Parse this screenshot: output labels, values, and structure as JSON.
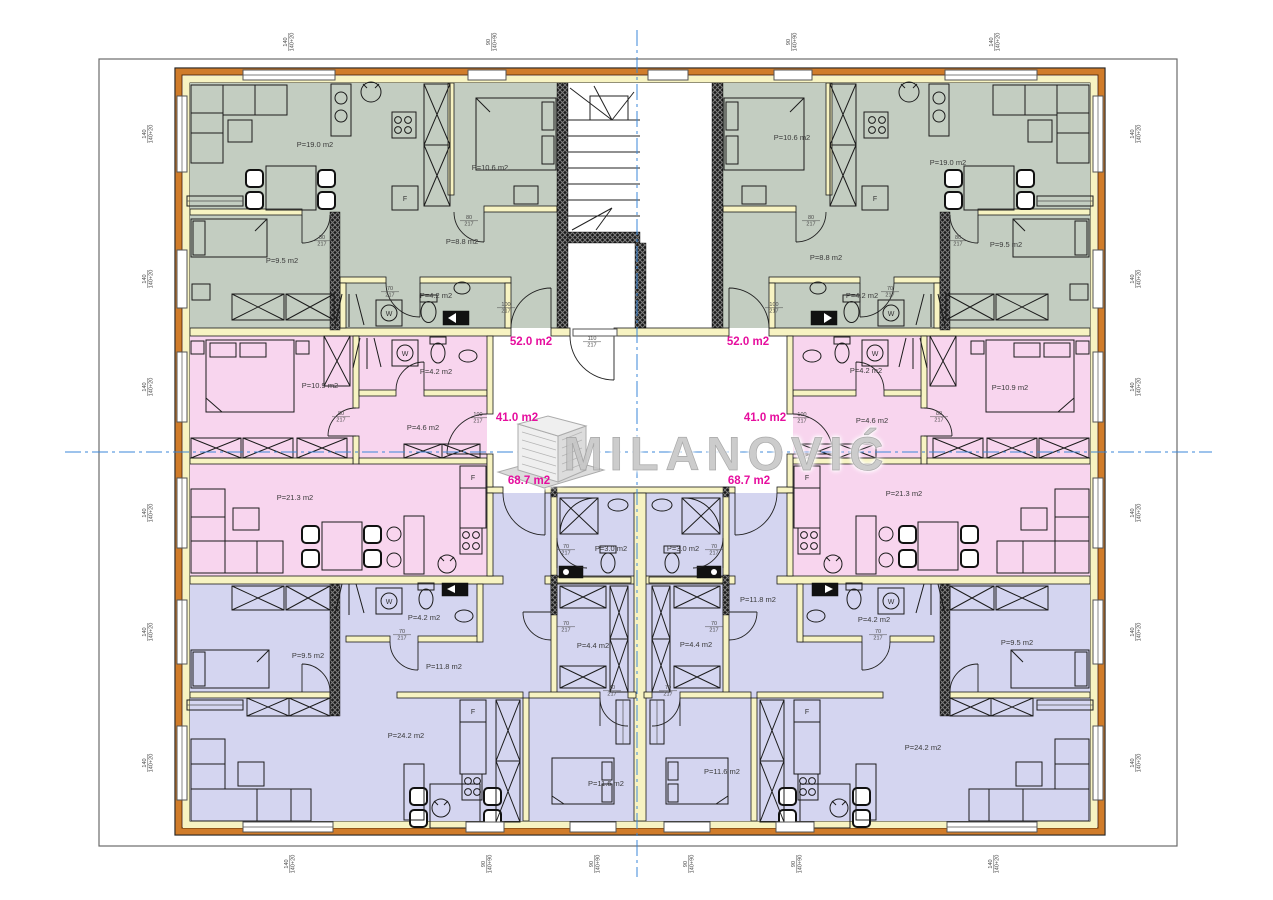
{
  "watermark": {
    "brand": "MILANOVIĆ",
    "icon": "building-3d-icon"
  },
  "colors": {
    "apartment_green": "#c3cdc1",
    "apartment_pink": "#f8d5ee",
    "apartment_blue": "#d4d5f0",
    "wall_yellow": "#f7f3c2",
    "facade_orange": "#d07c2a",
    "area_label_magenta": "#e60e9e",
    "centerline_blue": "#3b87d8"
  },
  "plan": {
    "apartments": [
      {
        "area_label": "52.0 m2",
        "color": "#c3cdc1"
      },
      {
        "area_label": "41.0 m2",
        "color": "#f8d5ee"
      },
      {
        "area_label": "68.7 m2",
        "color": "#d4d5f0"
      }
    ],
    "apartment_area_labels": [
      {
        "text": "52.0 m2",
        "x": 531,
        "y": 345
      },
      {
        "text": "52.0 m2",
        "x": 748,
        "y": 345
      },
      {
        "text": "41.0 m2",
        "x": 517,
        "y": 421
      },
      {
        "text": "41.0 m2",
        "x": 765,
        "y": 421
      },
      {
        "text": "68.7 m2",
        "x": 529,
        "y": 484
      },
      {
        "text": "68.7 m2",
        "x": 749,
        "y": 484
      }
    ],
    "room_labels": [
      {
        "text": "P=19.0 m2",
        "x": 315,
        "y": 147
      },
      {
        "text": "P=10.6 m2",
        "x": 490,
        "y": 170
      },
      {
        "text": "P=8.8 m2",
        "x": 462,
        "y": 244
      },
      {
        "text": "P=9.5 m2",
        "x": 282,
        "y": 263
      },
      {
        "text": "P=4.2 m2",
        "x": 436,
        "y": 298
      },
      {
        "text": "P=19.0 m2",
        "x": 948,
        "y": 165
      },
      {
        "text": "P=10.6 m2",
        "x": 792,
        "y": 140
      },
      {
        "text": "P=8.8 m2",
        "x": 826,
        "y": 260
      },
      {
        "text": "P=9.5 m2",
        "x": 1006,
        "y": 247
      },
      {
        "text": "P=4.2 m2",
        "x": 862,
        "y": 298
      },
      {
        "text": "P=10.9 m2",
        "x": 320,
        "y": 388
      },
      {
        "text": "P=4.2 m2",
        "x": 436,
        "y": 374
      },
      {
        "text": "P=4.6 m2",
        "x": 423,
        "y": 430
      },
      {
        "text": "P=21.3 m2",
        "x": 295,
        "y": 500
      },
      {
        "text": "P=10.9 m2",
        "x": 1010,
        "y": 390
      },
      {
        "text": "P=4.2 m2",
        "x": 866,
        "y": 373
      },
      {
        "text": "P=4.6 m2",
        "x": 872,
        "y": 423
      },
      {
        "text": "P=21.3 m2",
        "x": 904,
        "y": 496
      },
      {
        "text": "P=9.5 m2",
        "x": 308,
        "y": 658
      },
      {
        "text": "P=11.8 m2",
        "x": 444,
        "y": 669
      },
      {
        "text": "P=4.2 m2",
        "x": 424,
        "y": 620
      },
      {
        "text": "P=24.2 m2",
        "x": 406,
        "y": 738
      },
      {
        "text": "P=11.6 m2",
        "x": 606,
        "y": 786
      },
      {
        "text": "P=9.5 m2",
        "x": 1017,
        "y": 645
      },
      {
        "text": "P=11.8 m2",
        "x": 758,
        "y": 602
      },
      {
        "text": "P=4.2 m2",
        "x": 874,
        "y": 622
      },
      {
        "text": "P=24.2 m2",
        "x": 923,
        "y": 750
      },
      {
        "text": "P=11.6 m2",
        "x": 722,
        "y": 774
      },
      {
        "text": "P=3.0 m2",
        "x": 611,
        "y": 551
      },
      {
        "text": "P=3.0 m2",
        "x": 683,
        "y": 551
      },
      {
        "text": "P=4.4 m2",
        "x": 593,
        "y": 648
      },
      {
        "text": "P=4.4 m2",
        "x": 696,
        "y": 647
      }
    ],
    "fixture_labels": [
      {
        "text": "F",
        "x": 405,
        "y": 201
      },
      {
        "text": "F",
        "x": 875,
        "y": 201
      },
      {
        "text": "F",
        "x": 473,
        "y": 480
      },
      {
        "text": "F",
        "x": 807,
        "y": 480
      },
      {
        "text": "F",
        "x": 473,
        "y": 714
      },
      {
        "text": "F",
        "x": 807,
        "y": 714
      },
      {
        "text": "W",
        "x": 389,
        "y": 316
      },
      {
        "text": "W",
        "x": 891,
        "y": 316
      },
      {
        "text": "W",
        "x": 405,
        "y": 356
      },
      {
        "text": "W",
        "x": 875,
        "y": 356
      },
      {
        "text": "W",
        "x": 389,
        "y": 604
      },
      {
        "text": "W",
        "x": 891,
        "y": 604
      }
    ],
    "dimension_labels": [
      {
        "text": "110|217",
        "x": 592,
        "y": 340,
        "rot": 0
      },
      {
        "text": "100|217",
        "x": 506,
        "y": 306,
        "rot": 0
      },
      {
        "text": "100|217",
        "x": 774,
        "y": 306,
        "rot": 0
      },
      {
        "text": "100|217",
        "x": 478,
        "y": 416,
        "rot": 0
      },
      {
        "text": "100|217",
        "x": 802,
        "y": 416,
        "rot": 0
      },
      {
        "text": "80|217",
        "x": 322,
        "y": 239,
        "rot": 0
      },
      {
        "text": "80|217",
        "x": 958,
        "y": 239,
        "rot": 0
      },
      {
        "text": "80|217",
        "x": 469,
        "y": 219,
        "rot": 0
      },
      {
        "text": "80|217",
        "x": 811,
        "y": 219,
        "rot": 0
      },
      {
        "text": "80|217",
        "x": 341,
        "y": 415,
        "rot": 0
      },
      {
        "text": "80|217",
        "x": 939,
        "y": 415,
        "rot": 0
      },
      {
        "text": "70|217",
        "x": 390,
        "y": 290,
        "rot": 0
      },
      {
        "text": "70|217",
        "x": 890,
        "y": 290,
        "rot": 0
      },
      {
        "text": "70|217",
        "x": 566,
        "y": 548,
        "rot": 0
      },
      {
        "text": "70|217",
        "x": 714,
        "y": 548,
        "rot": 0
      },
      {
        "text": "70|217",
        "x": 566,
        "y": 625,
        "rot": 0
      },
      {
        "text": "70|217",
        "x": 714,
        "y": 625,
        "rot": 0
      },
      {
        "text": "70|217",
        "x": 402,
        "y": 633,
        "rot": 0
      },
      {
        "text": "70|217",
        "x": 878,
        "y": 633,
        "rot": 0
      },
      {
        "text": "70|217",
        "x": 612,
        "y": 689,
        "rot": 0
      },
      {
        "text": "70|217",
        "x": 668,
        "y": 689,
        "rot": 0
      },
      {
        "text": "140|140+20",
        "x": 287,
        "y": 42,
        "rot": -90
      },
      {
        "text": "90|140+90",
        "x": 490,
        "y": 42,
        "rot": -90
      },
      {
        "text": "90|140+90",
        "x": 790,
        "y": 42,
        "rot": -90
      },
      {
        "text": "140|140+20",
        "x": 993,
        "y": 42,
        "rot": -90
      },
      {
        "text": "140|140+20",
        "x": 288,
        "y": 864,
        "rot": -90
      },
      {
        "text": "90|140+90",
        "x": 485,
        "y": 864,
        "rot": -90
      },
      {
        "text": "90|140+90",
        "x": 593,
        "y": 864,
        "rot": -90
      },
      {
        "text": "90|140+90",
        "x": 687,
        "y": 864,
        "rot": -90
      },
      {
        "text": "90|140+90",
        "x": 795,
        "y": 864,
        "rot": -90
      },
      {
        "text": "140|140+20",
        "x": 992,
        "y": 864,
        "rot": -90
      },
      {
        "text": "140|140+20",
        "x": 146,
        "y": 134,
        "rot": -90
      },
      {
        "text": "140|140+20",
        "x": 146,
        "y": 279,
        "rot": -90
      },
      {
        "text": "140|140+20",
        "x": 146,
        "y": 387,
        "rot": -90
      },
      {
        "text": "140|140+20",
        "x": 146,
        "y": 513,
        "rot": -90
      },
      {
        "text": "140|140+20",
        "x": 146,
        "y": 632,
        "rot": -90
      },
      {
        "text": "140|140+20",
        "x": 146,
        "y": 763,
        "rot": -90
      },
      {
        "text": "140|140+20",
        "x": 1134,
        "y": 134,
        "rot": -90
      },
      {
        "text": "140|140+20",
        "x": 1134,
        "y": 279,
        "rot": -90
      },
      {
        "text": "140|140+20",
        "x": 1134,
        "y": 387,
        "rot": -90
      },
      {
        "text": "140|140+20",
        "x": 1134,
        "y": 513,
        "rot": -90
      },
      {
        "text": "140|140+20",
        "x": 1134,
        "y": 632,
        "rot": -90
      },
      {
        "text": "140|140+20",
        "x": 1134,
        "y": 763,
        "rot": -90
      }
    ]
  }
}
